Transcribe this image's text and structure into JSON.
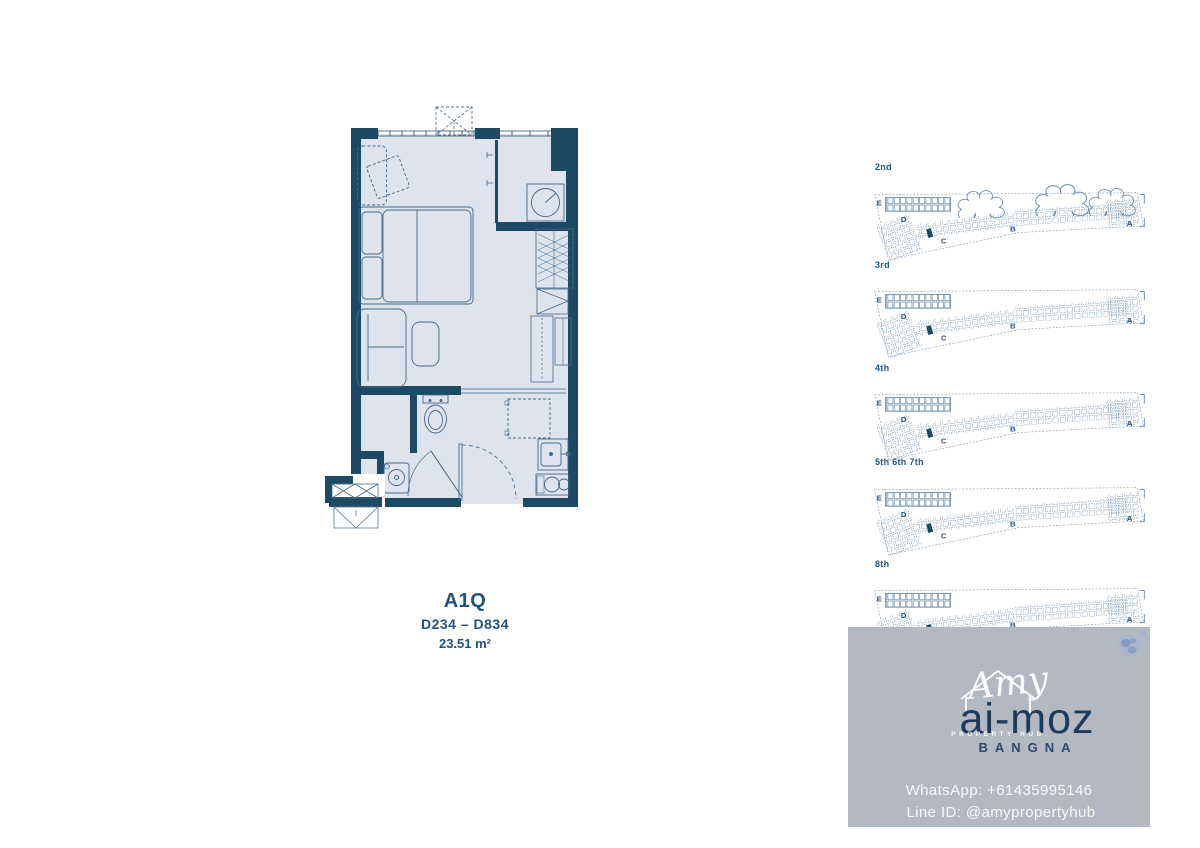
{
  "unit": {
    "name": "A1Q",
    "range": "D234 – D834",
    "area": "23.51 m²"
  },
  "floors": [
    {
      "label": "2nd"
    },
    {
      "label": "3rd"
    },
    {
      "label": "4th"
    },
    {
      "label": "5th 6th 7th"
    },
    {
      "label": "8th"
    }
  ],
  "sections": {
    "a": "A",
    "b": "B",
    "c": "C",
    "d": "D",
    "e": "E"
  },
  "watermark": {
    "script_name": "Amy",
    "brand": "ai-moz",
    "tagline": "PROPERTY HUB",
    "location": "BANGNA",
    "whatsapp": "WhatsApp: +61435995146",
    "line_id": "Line ID: @amypropertyhub",
    "compass_n": "N"
  },
  "colors": {
    "wall": "#1d4a63",
    "floor_fill": "#dfe3ee",
    "furniture_line": "#44688a",
    "site_line": "#51759a",
    "accent_text": "#23527a",
    "watermark_bg": "#b4b8c3",
    "brand_navy": "#1d3a5c",
    "white": "#ffffff"
  }
}
